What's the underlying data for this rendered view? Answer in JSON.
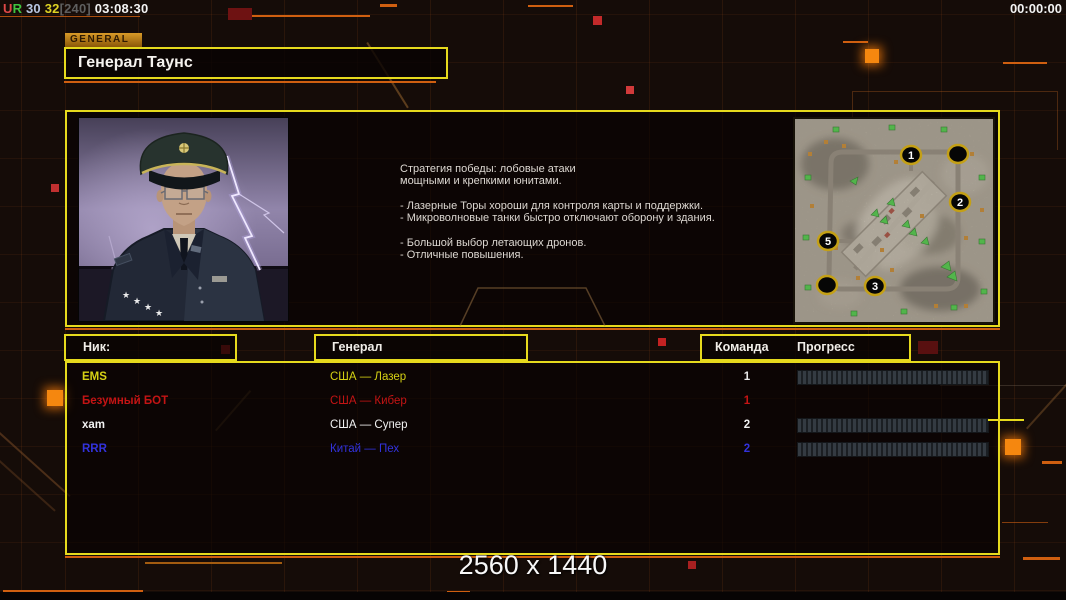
{
  "colors": {
    "accent_yellow": "#e6da1d",
    "accent_orange": "#cf5f10",
    "tab_background": "#c98c1e",
    "player_yellow": "#d6d214",
    "player_red": "#c41414",
    "player_white": "#f2f2f2",
    "player_blue": "#3232dc"
  },
  "status_bar": {
    "stat_u": "U",
    "stat_r": "R",
    "value_1": "30",
    "value_2": "32",
    "value_3": "[240]",
    "time_elapsed": "03:08:30",
    "game_timer": "00:00:00"
  },
  "general_tab_label": "GENERAL",
  "general_name": "Генерал Таунс",
  "briefing_lines": [
    "Стратегия победы: лобовые атаки",
    "мощными и крепкими юнитами.",
    "",
    "- Лазерные Торы хороши для контроля карты и поддержки.",
    "- Микроволновые танки быстро отключают оборону и здания.",
    "",
    "- Большой выбор летающих дронов.",
    "- Отличные повышения."
  ],
  "map": {
    "markers": [
      {
        "label": "1"
      },
      {
        "label": ""
      },
      {
        "label": "2"
      },
      {
        "label": "5"
      },
      {
        "label": "3"
      },
      {
        "label": ""
      }
    ]
  },
  "table": {
    "headers": {
      "nick": "Ник:",
      "general": "Генерал",
      "team": "Команда",
      "progress": "Прогресс"
    }
  },
  "players": [
    {
      "name": "EMS",
      "general": "США — Лазер",
      "team": "1",
      "color": "#d6d214",
      "team_color": "#e8e8e8",
      "has_progress_bar": true,
      "progress_percent": 0
    },
    {
      "name": "Безумный БОТ",
      "general": "США — Кибер",
      "team": "1",
      "color": "#c41414",
      "team_color": "#c41414",
      "has_progress_bar": false,
      "progress_percent": 0
    },
    {
      "name": "xam",
      "general": "США — Супер",
      "team": "2",
      "color": "#f2f2f2",
      "team_color": "#f2f2f2",
      "has_progress_bar": true,
      "progress_percent": 0
    },
    {
      "name": "RRR",
      "general": "Китай — Пех",
      "team": "2",
      "color": "#3232dc",
      "team_color": "#3232dc",
      "has_progress_bar": true,
      "progress_percent": 0
    }
  ],
  "watermark": "2560 x 1440"
}
